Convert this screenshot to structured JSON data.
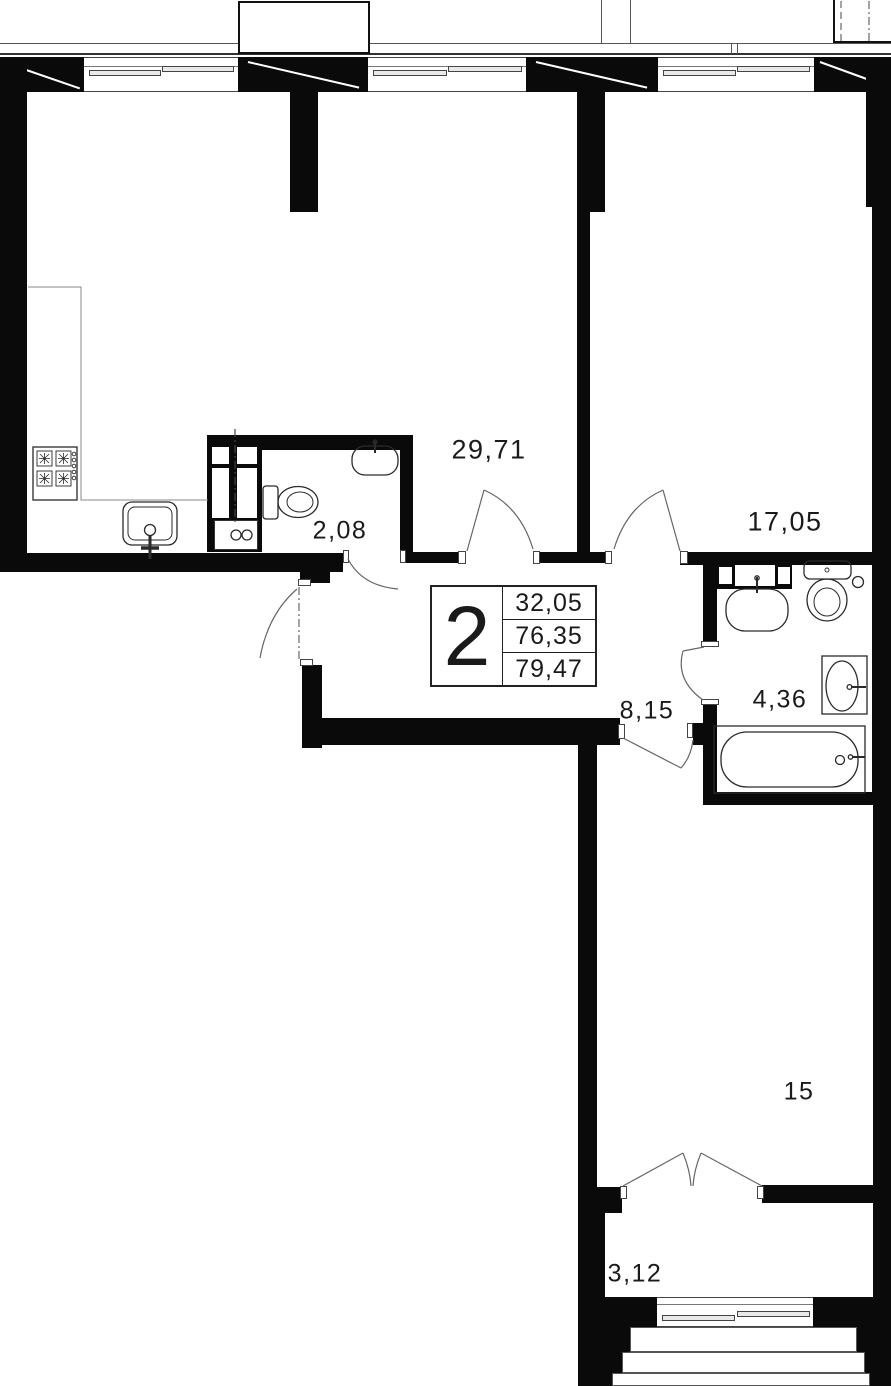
{
  "unit": {
    "rooms_count": "2",
    "area_living": "32,05",
    "area_total": "76,35",
    "area_overall": "79,47"
  },
  "room_areas": {
    "living_kitchen": "29,71",
    "bedroom": "17,05",
    "wc": "2,08",
    "hall": "8,15",
    "bathroom": "4,36",
    "room": "15",
    "balcony": "3,12"
  },
  "colors": {
    "wall": "#0a0a0a",
    "outline": "#555555",
    "text": "#1a1a1a"
  }
}
